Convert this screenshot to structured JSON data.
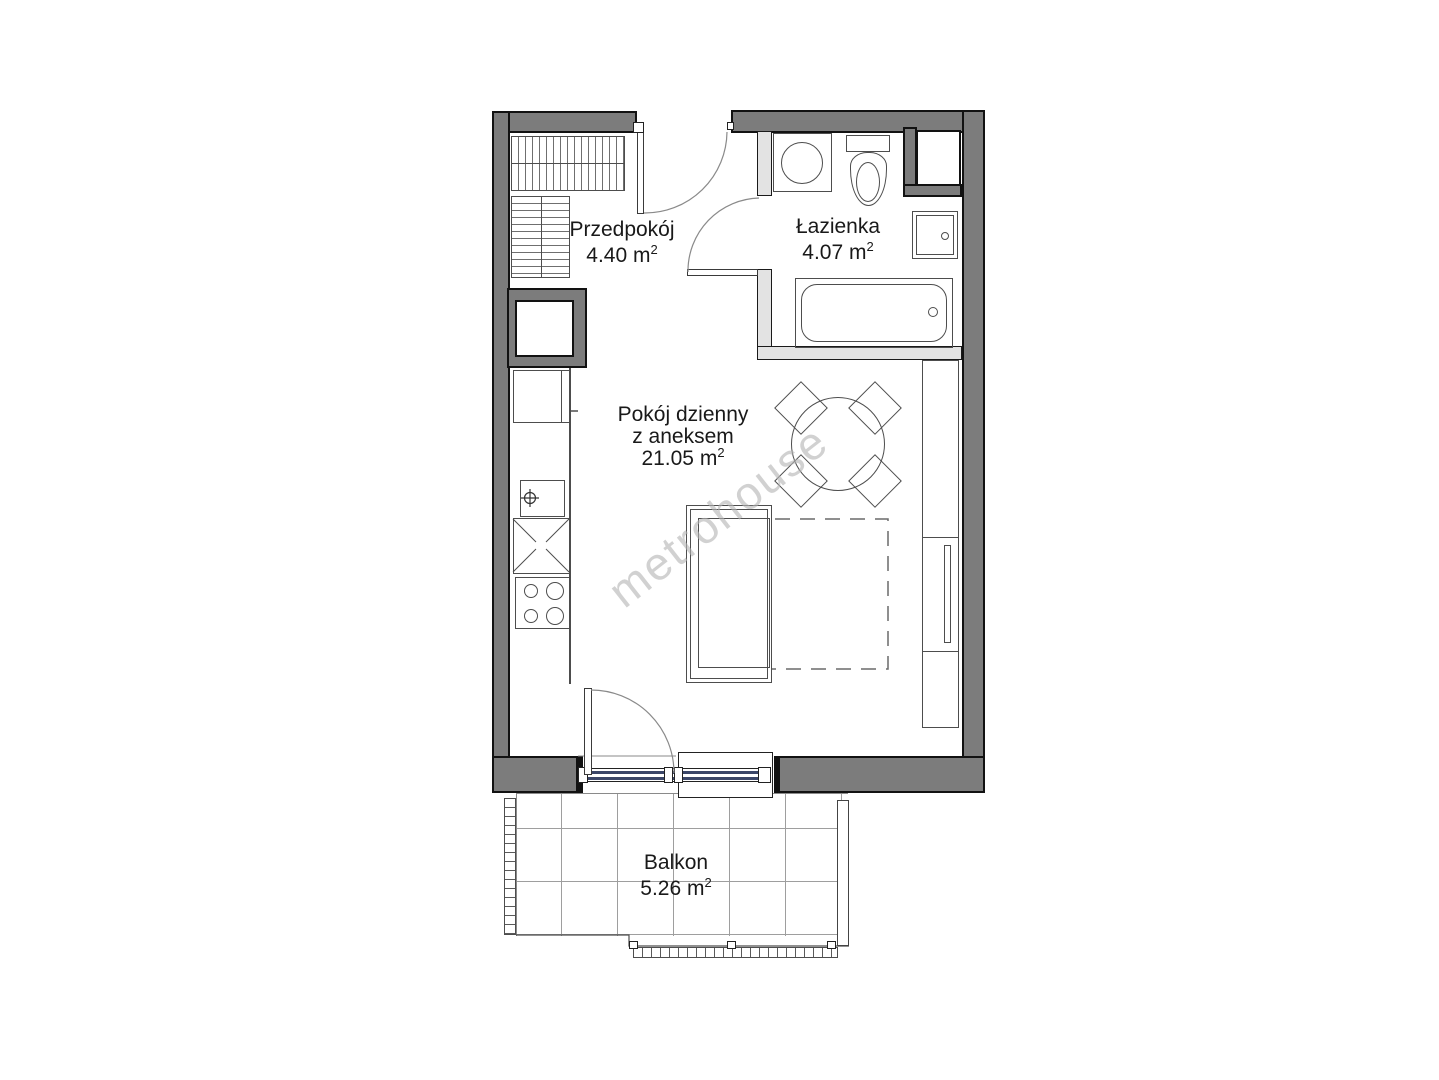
{
  "watermark": "metrohouse",
  "rooms": {
    "hallway": {
      "name": "Przedpokój",
      "area": "4.40 m",
      "area_sup": "2"
    },
    "bathroom": {
      "name": "Łazienka",
      "area": "4.07 m",
      "area_sup": "2"
    },
    "living": {
      "name_line1": "Pokój dzienny",
      "name_line2": "z aneksem",
      "area": "21.05 m",
      "area_sup": "2"
    },
    "balcony": {
      "name": "Balkon",
      "area": "5.26 m",
      "area_sup": "2"
    }
  },
  "colors": {
    "wall_dark": "#7c7c7c",
    "wall_light": "#e3e3e3",
    "glazing": "#3b4668",
    "line": "#4d4d4d",
    "watermark_color": "#b5b5b5"
  }
}
